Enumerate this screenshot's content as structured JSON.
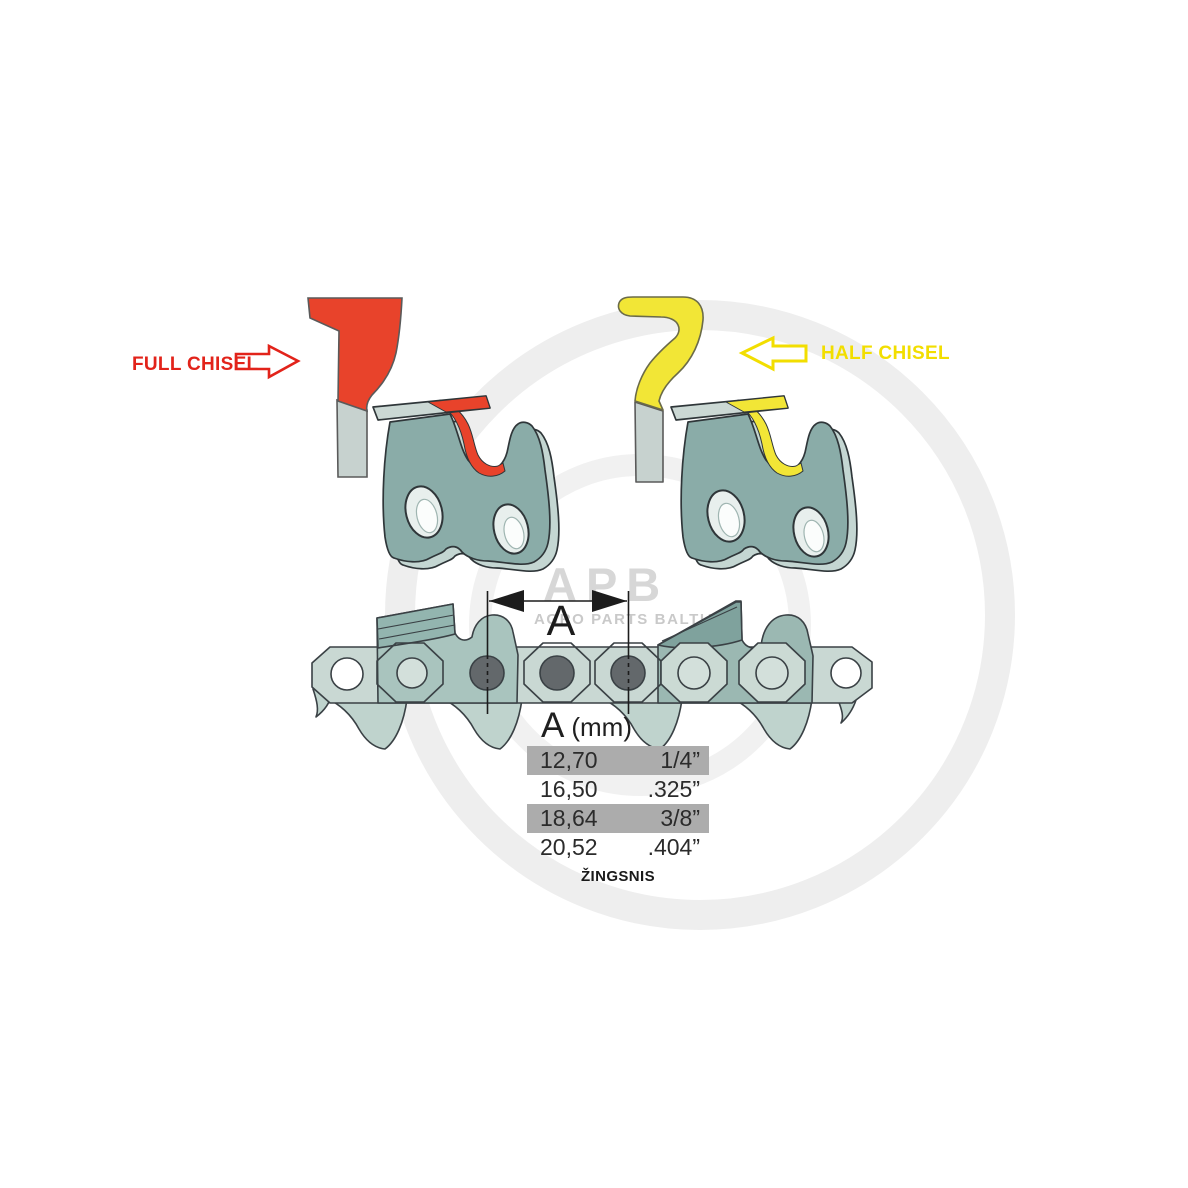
{
  "illustration": {
    "full_chisel": {
      "label": "FULL CHISEL",
      "arrow_direction": "right",
      "color": "#e2231a"
    },
    "half_chisel": {
      "label": "HALF CHISEL",
      "arrow_direction": "left",
      "color": "#f2de00"
    },
    "dimension_label": "A"
  },
  "pitch_table": {
    "header": {
      "dimension": "A",
      "unit": "(mm)"
    },
    "rows": [
      {
        "mm": "12,70",
        "inches": "1/4”",
        "highlighted": true
      },
      {
        "mm": "16,50",
        "inches": ".325”",
        "highlighted": false
      },
      {
        "mm": "18,64",
        "inches": "3/8”",
        "highlighted": true
      },
      {
        "mm": "20,52",
        "inches": ".404”",
        "highlighted": false
      }
    ],
    "caption": "ŽINGSNIS"
  },
  "watermark": {
    "brand": "APB",
    "subtitle": "AGRO PARTS BALTIJA"
  },
  "colors": {
    "full_chisel_red": "#e8432b",
    "half_chisel_yellow": "#f2e636",
    "chain_body_teal": "#a9c4be",
    "chain_strap_light": "#c9d8d3",
    "cutter_plate_dark": "#7fa29d",
    "rivet_gray": "#63686b",
    "outline": "#3a4145",
    "table_highlight": "#acacac"
  }
}
